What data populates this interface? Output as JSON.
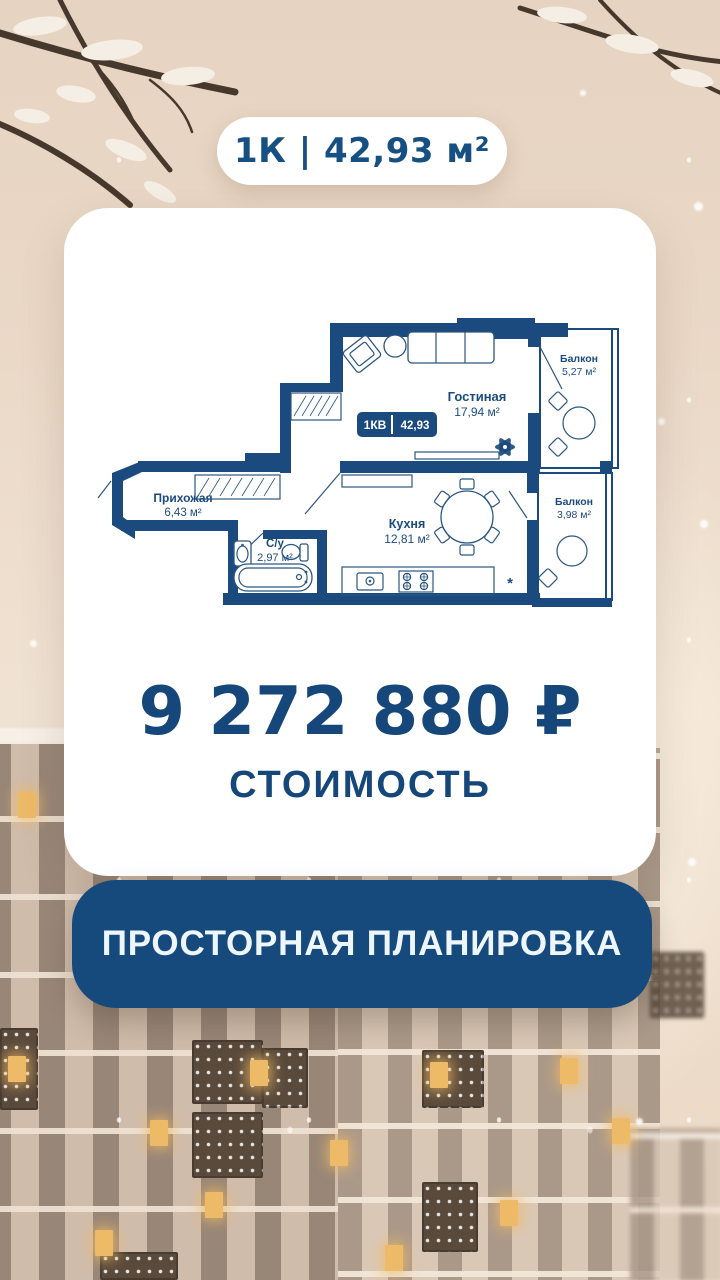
{
  "badge": {
    "text": "1К | 42,93 м²"
  },
  "plan": {
    "unit_badge": {
      "left": "1КВ",
      "right": "42,93"
    },
    "ac_symbol": "*",
    "rooms": {
      "living": {
        "name": "Гостиная",
        "area": "17,94 м²"
      },
      "balcony_top": {
        "name": "Балкон",
        "area": "5,27 м²"
      },
      "hallway": {
        "name": "Прихожая",
        "area": "6,43 м²"
      },
      "bathroom": {
        "name": "С/у",
        "area": "2,97 м²"
      },
      "kitchen": {
        "name": "Кухня",
        "area": "12,81 м²"
      },
      "balcony_bottom": {
        "name": "Балкон",
        "area": "3,98 м²"
      }
    }
  },
  "price": {
    "value": "9 272 880 ₽",
    "label": "СТОИМОСТЬ"
  },
  "cta": {
    "label": "ПРОСТОРНАЯ ПЛАНИРОВКА"
  },
  "colors": {
    "navy": "#1b4b7e",
    "navy-deep": "#174a7c",
    "card": "#ffffff"
  }
}
